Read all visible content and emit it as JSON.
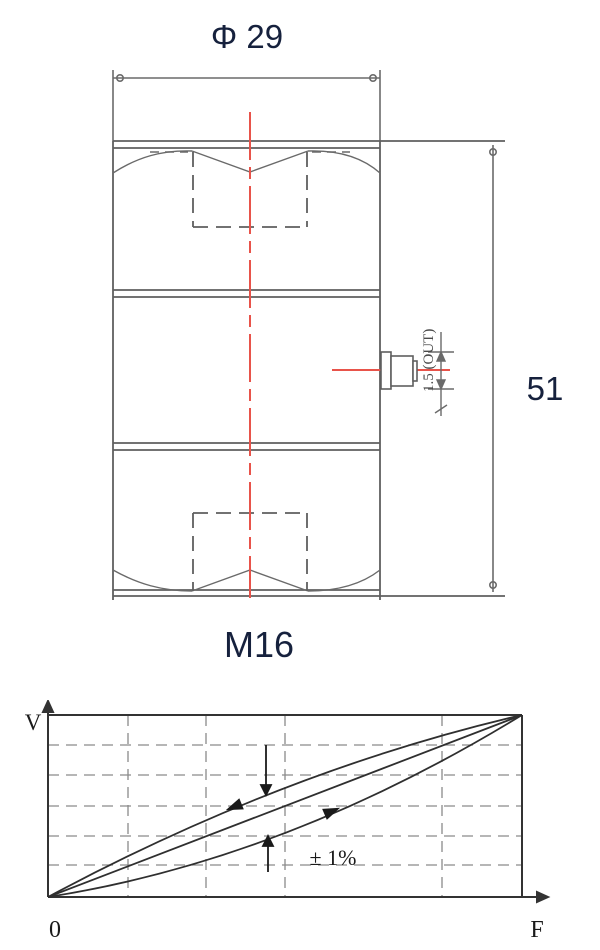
{
  "drawing": {
    "diameter_label": "Φ 29",
    "height_label": "51",
    "cable_label": "1.5 (OUT)",
    "thread_label": "M16"
  },
  "graph": {
    "y_axis_label": "V",
    "x_axis_label": "F",
    "origin_label": "0",
    "tolerance_label": "± 1%"
  },
  "colors": {
    "drawing_line": "#6a6a6a",
    "part_outline": "#5f5f5f",
    "centerline_red": "#e8534a",
    "dimension_text": "#16213d",
    "graph_line": "#2f2f2f",
    "gridline": "#8a8a8a"
  },
  "chart_data": {
    "type": "line",
    "title": "Output characteristic with hysteresis band",
    "xlabel": "F",
    "ylabel": "V",
    "x_normalized": [
      0,
      0.125,
      0.25,
      0.375,
      0.5,
      0.625,
      0.75,
      0.875,
      1
    ],
    "series": [
      {
        "name": "ideal-linear-response",
        "values": [
          0,
          0.125,
          0.25,
          0.375,
          0.5,
          0.625,
          0.75,
          0.875,
          1
        ]
      },
      {
        "name": "unloading-upper-curve",
        "values": [
          0,
          0.17,
          0.32,
          0.47,
          0.6,
          0.72,
          0.82,
          0.92,
          1
        ]
      },
      {
        "name": "loading-lower-curve",
        "values": [
          0,
          0.06,
          0.14,
          0.24,
          0.35,
          0.49,
          0.64,
          0.81,
          1
        ]
      }
    ],
    "annotations": [
      "± 1%"
    ],
    "axis_range": {
      "x": [
        "0",
        "F"
      ],
      "y": [
        "0",
        "V"
      ]
    },
    "grid": "dashed",
    "legend": "none"
  }
}
